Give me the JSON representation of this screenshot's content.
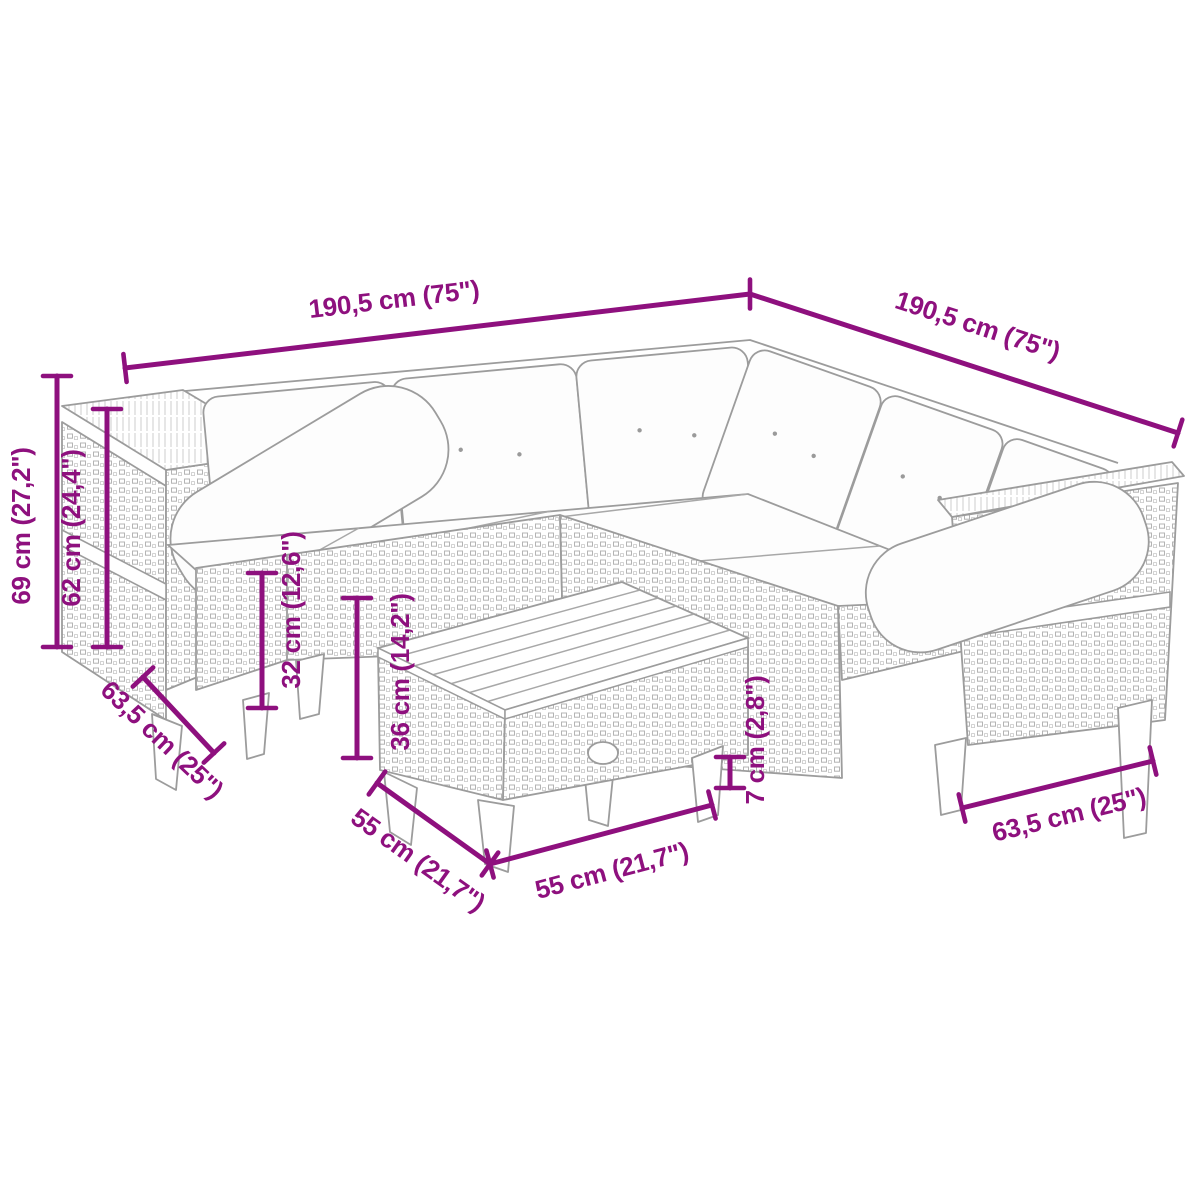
{
  "figure": {
    "title": "Garden rattan corner sofa set with table - dimension diagram",
    "accent_color": "#8E107E",
    "outline_color": "#9c9c9c"
  },
  "dimensions": {
    "sofa_width_left": "190,5 cm (75\")",
    "sofa_width_right": "190,5 cm (75\")",
    "height_total": "69 cm (27,2\")",
    "height_frame": "62 cm (24,4\")",
    "seat_height": "32 cm (12,6\")",
    "table_height": "36 cm (14,2\")",
    "sofa_depth_left": "63,5 cm (25\")",
    "table_depth": "55 cm (21,7\")",
    "table_width": "55 cm (21,7\")",
    "leg_height": "7 cm (2,8\")",
    "sofa_depth_right": "63,5 cm (25\")"
  }
}
